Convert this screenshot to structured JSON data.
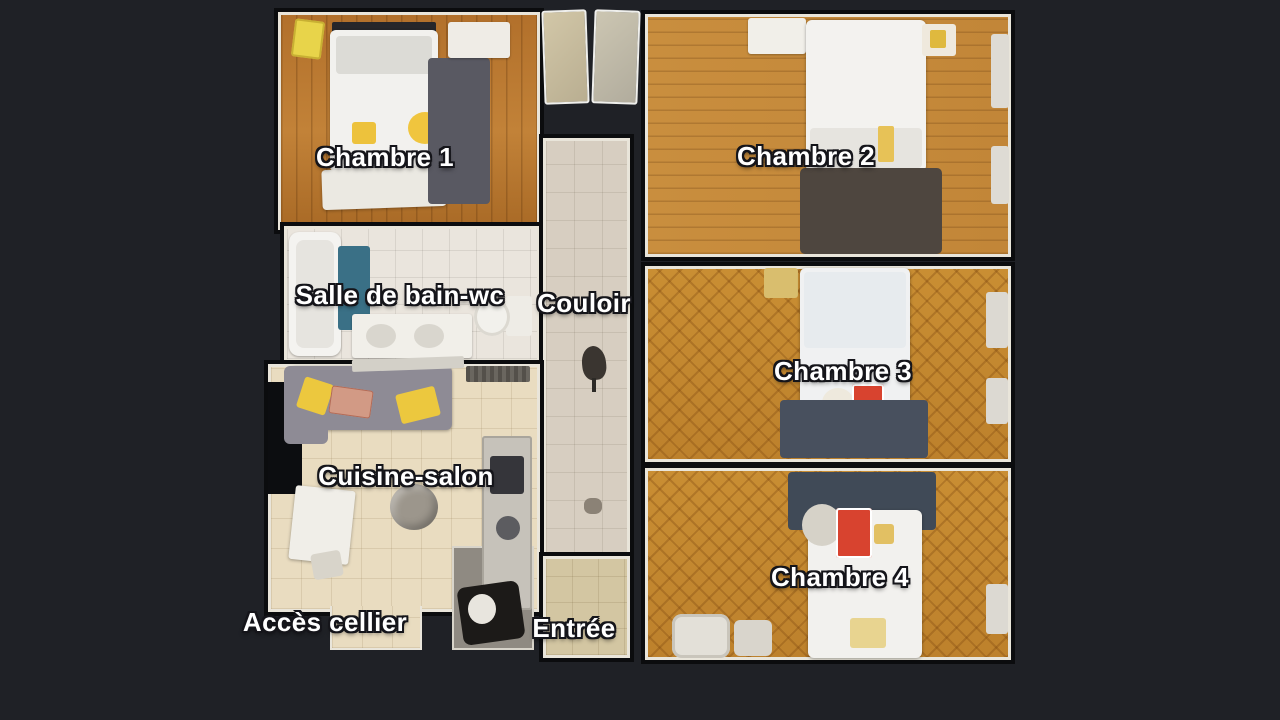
{
  "view": {
    "title": "Plan d'appartement — vue de dessus",
    "background_color": "#1f2126"
  },
  "rooms": {
    "chambre1": {
      "label": "Chambre 1"
    },
    "chambre2": {
      "label": "Chambre 2"
    },
    "salle_de_bain_wc": {
      "label": "Salle de bain-wc"
    },
    "couloir": {
      "label": "Couloir"
    },
    "chambre3": {
      "label": "Chambre 3"
    },
    "cuisine_salon": {
      "label": "Cuisine-salon"
    },
    "chambre4": {
      "label": "Chambre 4"
    },
    "acces_cellier": {
      "label": "Accès cellier"
    },
    "entree": {
      "label": "Entrée"
    }
  },
  "colors": {
    "wood_plank": "#bb7c30",
    "wood_herringbone": "#c4882f",
    "tile_bathroom": "#eae5dd",
    "tile_kitchen": "#e9dcc0",
    "tile_hallway": "#d7cec1",
    "tile_entry": "#d3c6a2",
    "rug_dark": "#4a4e58",
    "bed_white": "#f2f1ee",
    "accent_yellow": "#ecc83e",
    "accent_red": "#d8432f",
    "accent_blue": "#3a7086",
    "label_text": "#ffffff",
    "label_outline": "#15151a"
  }
}
